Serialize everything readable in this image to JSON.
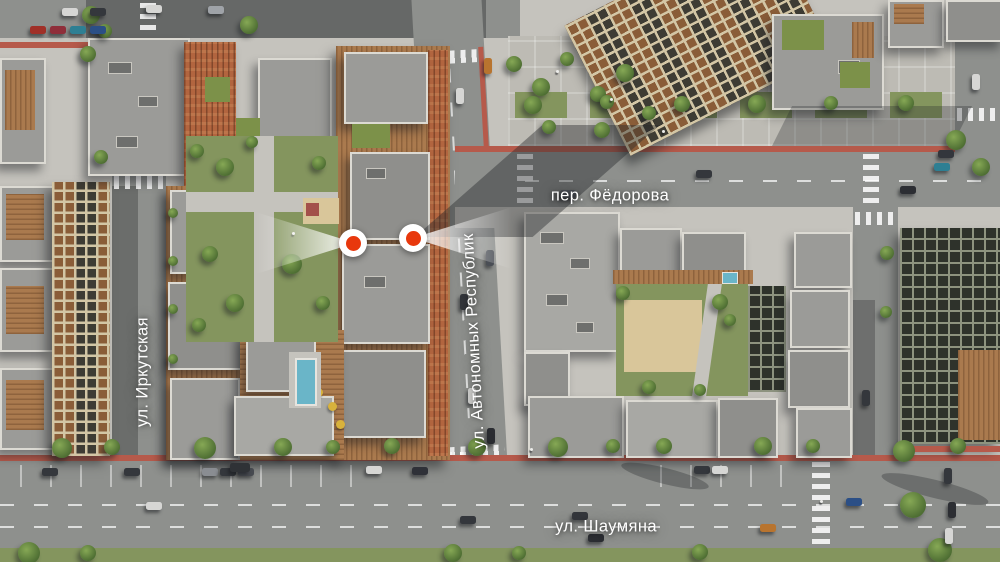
{
  "labels": {
    "street_left": "ул. Иркутская",
    "street_center": "ул. Автономных Республик",
    "lane_top": "пер. Фёдорова",
    "street_bottom": "ул. Шаумяна"
  },
  "markers": {
    "count": 2,
    "color": "#e8380d",
    "items": [
      {
        "id": "viewpoint-1",
        "direction": "west"
      },
      {
        "id": "viewpoint-2",
        "direction": "east"
      }
    ]
  },
  "palette": {
    "asphalt": "#8e908d",
    "sidewalk": "#c5c3bd",
    "roof_gray": "#9b9b98",
    "parapet": "#dcdad3",
    "brick": "#b2653f",
    "wood_deck": "#aa7a4e",
    "lawn": "#84955e",
    "tree": "#55763a",
    "sand": "#d9c69a",
    "pool": "#6ab5c8",
    "bike_lane": "#b65a4b",
    "label_text": "#ffffff"
  }
}
